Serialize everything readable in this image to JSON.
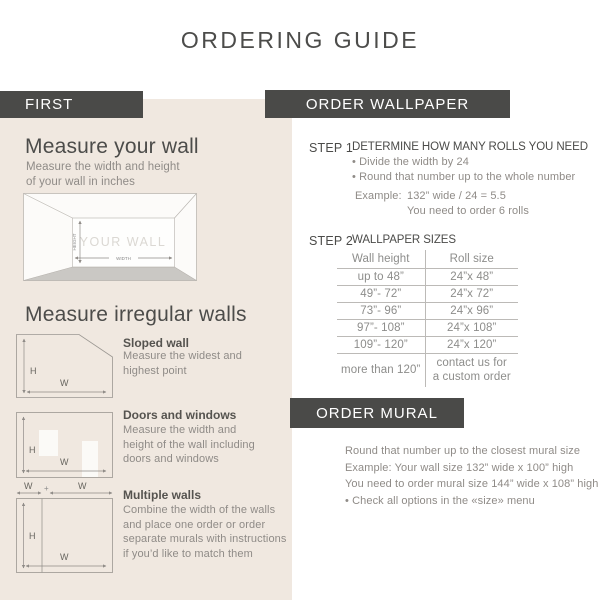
{
  "title": "ORDERING GUIDE",
  "colors": {
    "bar_background": "#4a4a48",
    "panel_background": "#f0e8e0",
    "heading_text": "#4c4c4a",
    "body_text": "#8f8b87",
    "diagram_stroke": "#9b9792",
    "floor_fill": "#cac8c4"
  },
  "left": {
    "header": "FIRST",
    "measure_wall": {
      "heading": "Measure your wall",
      "subtext": "Measure the width and height\nof your wall in inches",
      "diagram": {
        "wall_label": "YOUR WALL",
        "height_label": "HEIGHT",
        "width_label": "WIDTH"
      }
    },
    "irregular": {
      "heading": "Measure irregular walls",
      "diagram_labels": {
        "h": "H",
        "w": "W",
        "plus": "+"
      },
      "items": [
        {
          "label": "Sloped wall",
          "description": "Measure the widest and\nhighest point"
        },
        {
          "label": "Doors and windows",
          "description": "Measure the width and\nheight of the wall including\ndoors and windows"
        },
        {
          "label": "Multiple walls",
          "description": "Combine the width of the walls\nand place one order or order\nseparate murals with instructions\nif you’d like to match them"
        }
      ]
    }
  },
  "order_wallpaper": {
    "header": "ORDER WALLPAPER",
    "step1": {
      "label": "STEP 1",
      "title": "DETERMINE HOW MANY ROLLS YOU NEED",
      "bullets": [
        "• Divide the width by 24",
        "• Round that number up to the whole number"
      ],
      "example_label": "Example:",
      "example_calc": "132” wide / 24 = 5.5",
      "example_result": "You need to order 6 rolls"
    },
    "step2": {
      "label": "STEP 2",
      "title": "WALLPAPER SIZES",
      "table": {
        "columns": [
          "Wall height",
          "Roll size"
        ],
        "rows": [
          [
            "up to 48”",
            "24”x 48”"
          ],
          [
            "49”- 72”",
            "24”x 72”"
          ],
          [
            "73”- 96”",
            "24”x 96”"
          ],
          [
            "97”- 108”",
            "24”x 108”"
          ],
          [
            "109”- 120”",
            "24”x 120”"
          ],
          [
            "more than 120”",
            "contact us for\na custom order"
          ]
        ]
      }
    }
  },
  "order_mural": {
    "header": "ORDER MURAL",
    "lines": [
      "Round that number up to the closest mural size",
      "Example: Your wall size 132” wide x 100” high",
      "You need to order mural size 144” wide x 108” high",
      "• Check all options in the «size» menu"
    ]
  }
}
